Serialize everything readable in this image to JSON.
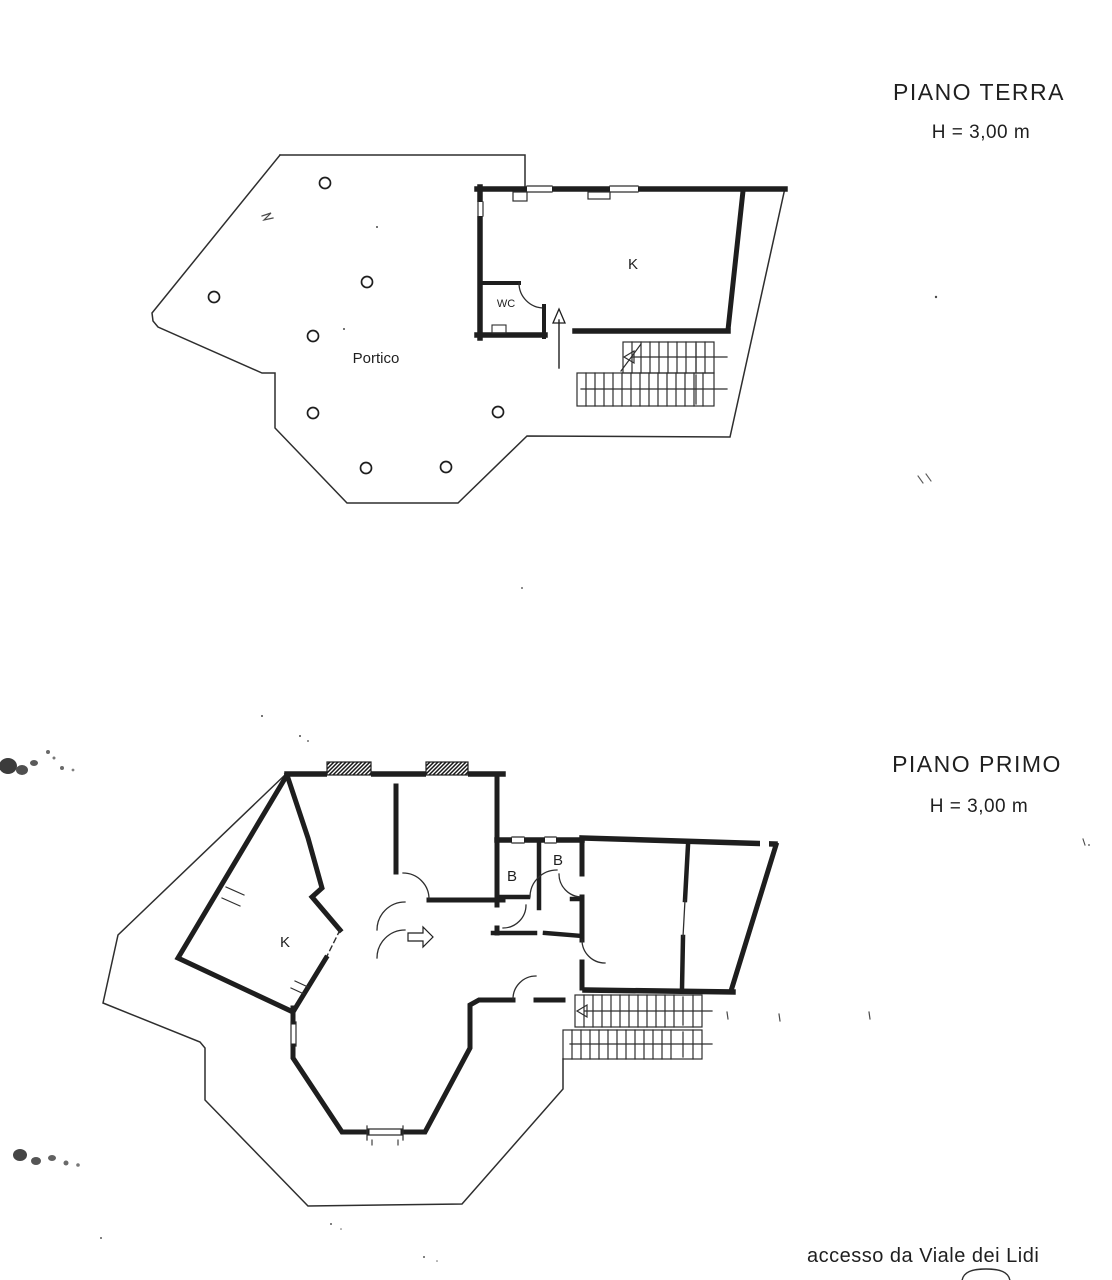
{
  "palette": {
    "paper": "#ffffff",
    "ink": "#1e1e1e",
    "thin_line": "#2e2e2e",
    "noise": "#4a4a4a"
  },
  "ground_floor": {
    "title": "PIANO TERRA",
    "height_note": "H = 3,00 m",
    "room_labels": {
      "portico": "Portico",
      "kitchen": "K",
      "wc": "WC"
    }
  },
  "first_floor": {
    "title": "PIANO PRIMO",
    "height_note": "H = 3,00 m",
    "room_labels": {
      "kitchen": "K",
      "bathroom_1": "B",
      "bathroom_2": "B"
    }
  },
  "footer": {
    "access_note": "accesso da Viale dei Lidi"
  }
}
